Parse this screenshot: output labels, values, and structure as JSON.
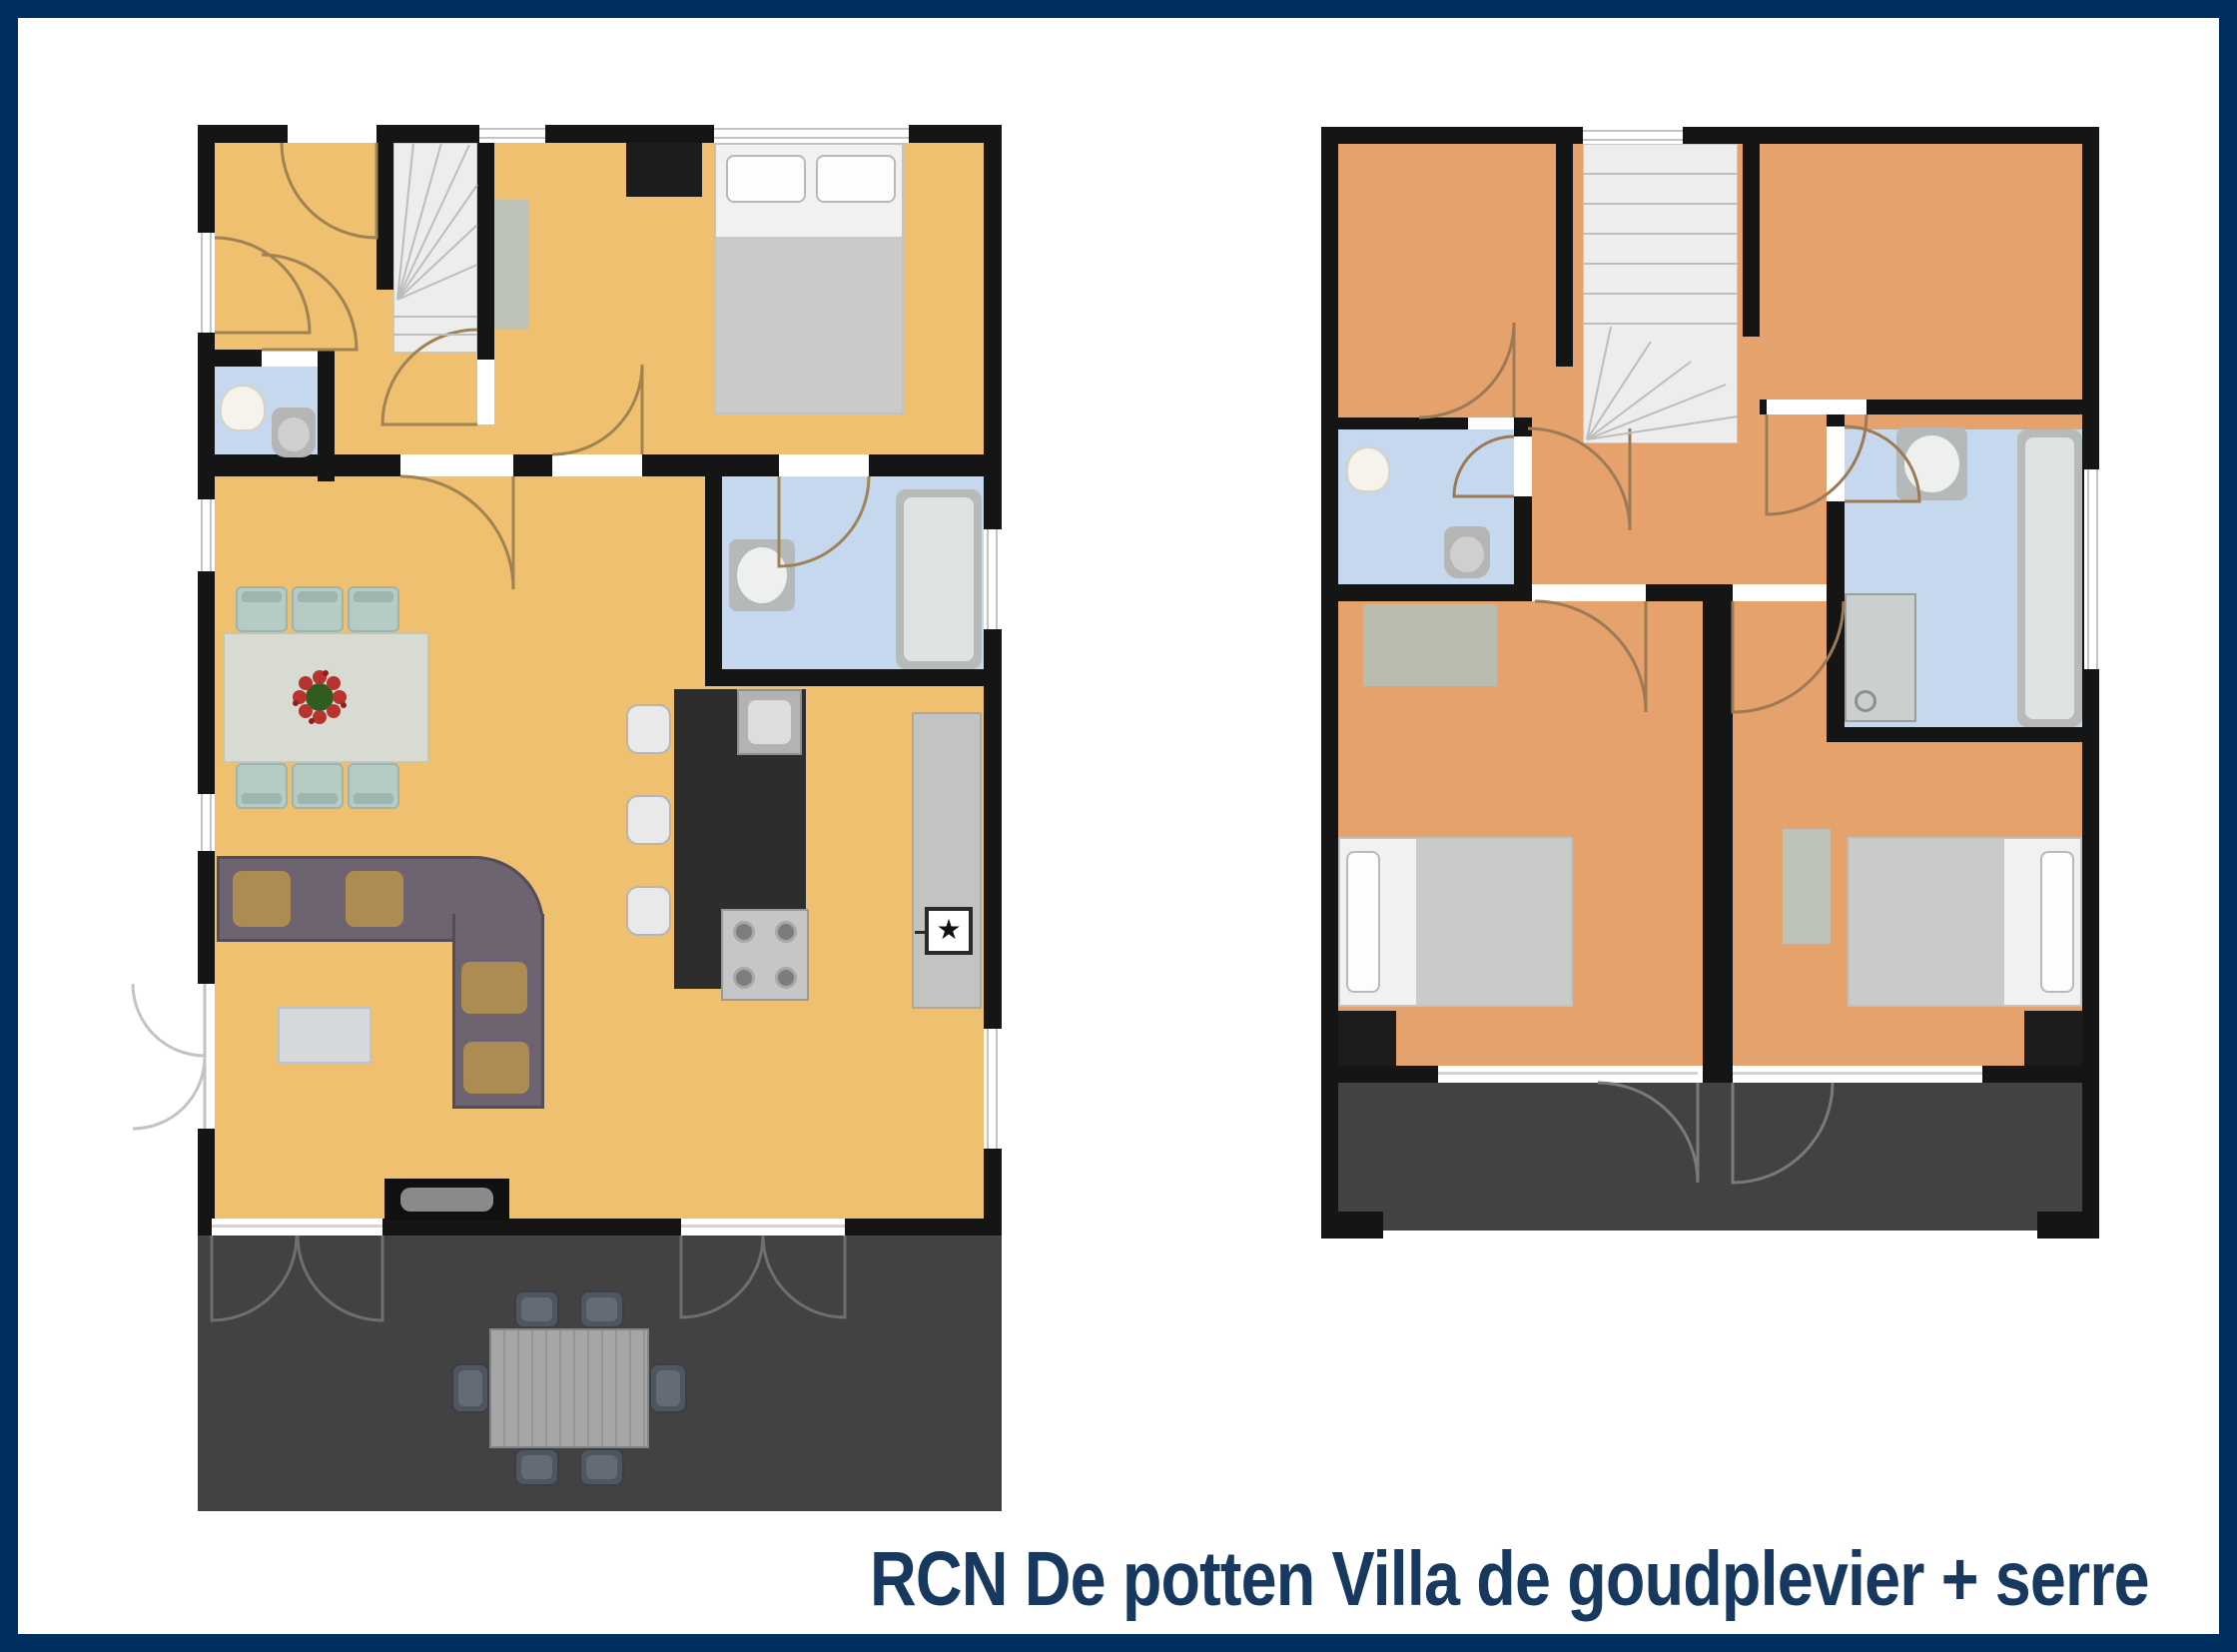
{
  "caption": {
    "text": "RCN De potten Villa de goudplevier + serre"
  },
  "icons": {
    "appliance_star": "★"
  },
  "colors": {
    "frame": "#00305f",
    "background": "#ffffff",
    "caption_text": "#17395f",
    "wall": "#151515",
    "ground_floor": "#eec06f",
    "first_floor": "#e5a26d",
    "wet_room": "#c5d8ee",
    "terrace": "#424242",
    "sofa": "#6e6370",
    "kitchen_island": "#2d2d2d"
  }
}
